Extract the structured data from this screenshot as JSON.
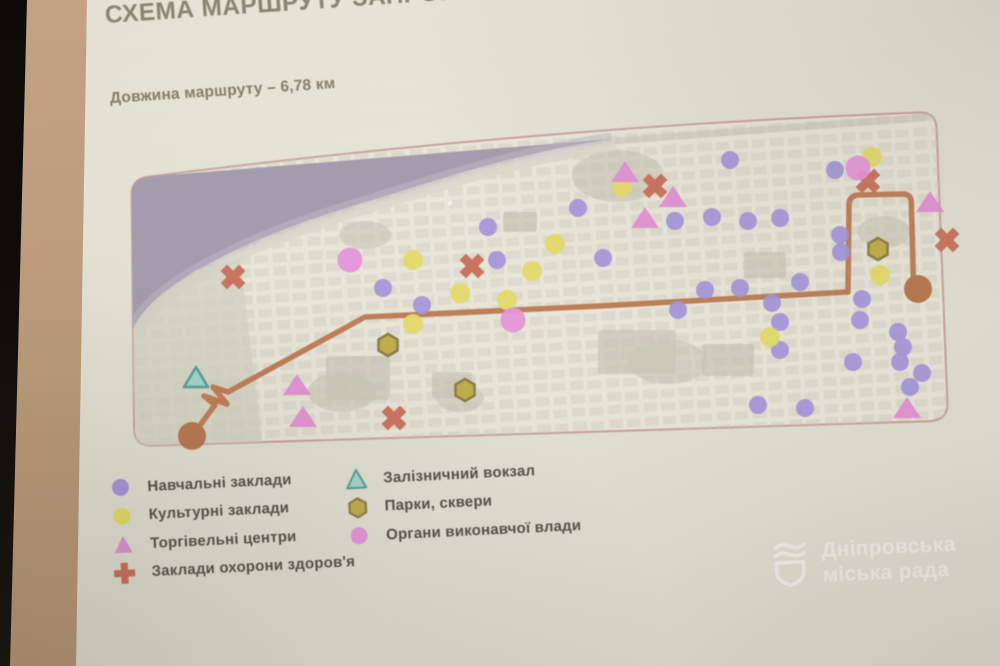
{
  "slide": {
    "title": "СХЕМА МАРШРУТУ ЗАПРОПОНОВАНОГО",
    "subtitle": "Довжина маршруту – 6,78 км"
  },
  "legend": {
    "items": [
      {
        "key": "educational",
        "shape": "circle",
        "color": "#a79ae3",
        "label": "Навчальні заклади"
      },
      {
        "key": "cultural",
        "shape": "circle",
        "color": "#ece26b",
        "label": "Культурні заклади"
      },
      {
        "key": "shopping",
        "shape": "triangle",
        "color": "#ea93dc",
        "label": "Торгівельні центри"
      },
      {
        "key": "health",
        "shape": "cross",
        "color": "#d0715c",
        "label": "Заклади охорони здоров'я"
      },
      {
        "key": "railway",
        "shape": "triangle-outline",
        "color": "#abdcd4",
        "border": "#4fa89b",
        "label": "Залізничний вокзал"
      },
      {
        "key": "parks",
        "shape": "hexagon",
        "color": "#c6b44c",
        "border": "#8f814a",
        "label": "Парки, сквери"
      },
      {
        "key": "executive",
        "shape": "circle",
        "color": "#ee99e3",
        "label": "Органи виконавчої влади"
      }
    ]
  },
  "watermark": {
    "line1": "Дніпровська",
    "line2": "міська рада"
  },
  "map": {
    "land_color": "#f1eee2",
    "border_color": "#d2a3a3",
    "river_color": "#a9a1b4",
    "route": {
      "color": "#c5825a",
      "endpoint_color": "#bd7a51",
      "main_path": "M192 436 L215 405 L204 396 L227 404 L213 387 L228 392 L365 317 L600 306 L848 292",
      "loop_path": "M848 292 L849 205 Q849 196 858 195 L902 194 Q911 193.5 911.3 202 L913.4 280 Q913.6 288 918 288.5",
      "endpoints": [
        [
          192,
          436
        ],
        [
          918,
          289
        ]
      ]
    },
    "markers": {
      "educational": {
        "color": "#a79ae3",
        "points": [
          [
            383,
            288
          ],
          [
            422,
            305
          ],
          [
            488,
            227
          ],
          [
            497,
            260
          ],
          [
            578,
            208
          ],
          [
            603,
            258
          ],
          [
            675,
            221
          ],
          [
            712,
            217
          ],
          [
            730,
            160
          ],
          [
            748,
            221
          ],
          [
            780,
            218
          ],
          [
            678,
            310
          ],
          [
            705,
            290
          ],
          [
            835,
            170
          ],
          [
            840,
            235
          ],
          [
            841,
            252
          ],
          [
            800,
            282
          ],
          [
            740,
            288
          ],
          [
            772,
            303
          ],
          [
            862,
            299
          ],
          [
            780,
            322
          ],
          [
            860,
            320
          ],
          [
            898,
            332
          ],
          [
            780,
            350
          ],
          [
            903,
            347
          ],
          [
            900,
            362
          ],
          [
            853,
            362
          ],
          [
            922,
            373
          ],
          [
            910,
            387
          ],
          [
            758,
            405
          ],
          [
            805,
            408
          ]
        ]
      },
      "cultural": {
        "color": "#ece26b",
        "points": [
          [
            413,
            260
          ],
          [
            460,
            293
          ],
          [
            413,
            324
          ],
          [
            555,
            244
          ],
          [
            532,
            271
          ],
          [
            507,
            300
          ],
          [
            622,
            187
          ],
          [
            872,
            157
          ],
          [
            880,
            275
          ],
          [
            770,
            337
          ]
        ]
      },
      "shopping": {
        "color": "#ea93dc",
        "points": [
          [
            625,
            172
          ],
          [
            673,
            197
          ],
          [
            645,
            218
          ],
          [
            930,
            202
          ],
          [
            297,
            385
          ],
          [
            303,
            417
          ],
          [
            907,
            408
          ]
        ]
      },
      "health": {
        "color": "#d0715c",
        "points": [
          [
            233,
            277
          ],
          [
            472,
            266
          ],
          [
            655,
            186
          ],
          [
            868,
            181
          ],
          [
            947,
            240
          ],
          [
            394,
            418
          ]
        ]
      },
      "railway": {
        "color": "#abdcd4",
        "border": "#4fa89b",
        "points": [
          [
            196,
            378
          ]
        ]
      },
      "parks": {
        "color": "#c6b44c",
        "border": "#8f814a",
        "points": [
          [
            388,
            345
          ],
          [
            465,
            390
          ],
          [
            878,
            249
          ]
        ]
      },
      "executive": {
        "color": "#ee99e3",
        "points": [
          [
            350,
            260
          ],
          [
            513,
            320
          ],
          [
            858,
            168
          ]
        ]
      }
    }
  }
}
